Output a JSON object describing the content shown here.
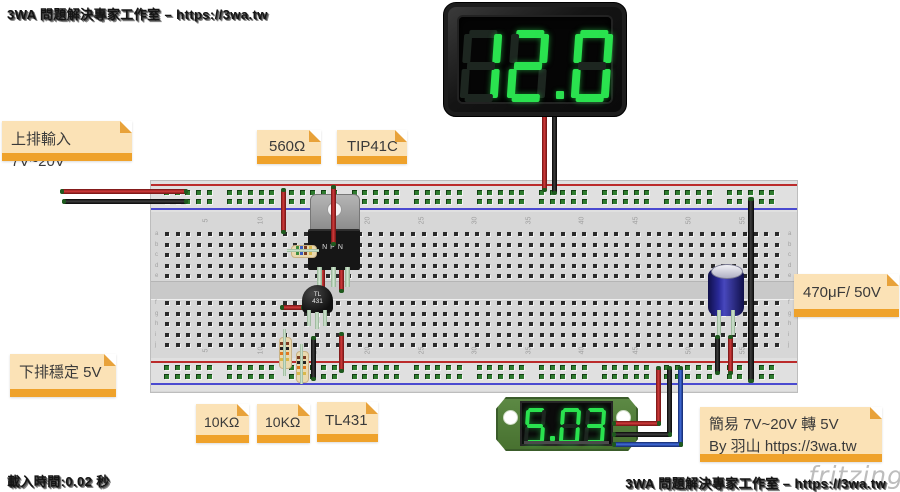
{
  "watermarks": {
    "top_left": "3WA 問題解決專家工作室 – https://3wa.tw",
    "bottom_left": "載入時間:0.02 秒",
    "bottom_right": "3WA 問題解決專家工作室 – https://3wa.tw",
    "fritzing_logo": "fritzing"
  },
  "notes": {
    "input_top": "上排輸入 7V~20V",
    "resistor_560": "560Ω",
    "tip41c": "TIP41C",
    "capacitor": "470μF/ 50V",
    "output_bottom": "下排穩定 5V",
    "r10k_left": "10KΩ",
    "r10k_right": "10KΩ",
    "tl431": "TL431",
    "author_line1": "簡易 7V~20V 轉 5V",
    "author_line2": "By 羽山 https://3wa.tw"
  },
  "displays": {
    "large_voltmeter": {
      "value": "12.0",
      "segment_on_color": "#2ae24f"
    },
    "small_voltmeter": {
      "value": "5.03",
      "segment_on_color": "#2ae24f"
    }
  },
  "components": {
    "transistor_label": "NPN",
    "tl431_label_line1": "TL",
    "tl431_label_line2": "431"
  },
  "colors": {
    "note_bg": "#fbe2b6",
    "note_bar": "#efa22b",
    "wire_red": "#b52222",
    "wire_black": "#1d1d1d",
    "wire_blue": "#2b56c4",
    "rail_red_line": "#bb2b2b",
    "rail_blue_line": "#4a4ad0",
    "pcb_green": "#55823f",
    "digit_green": "#2ae24f"
  }
}
